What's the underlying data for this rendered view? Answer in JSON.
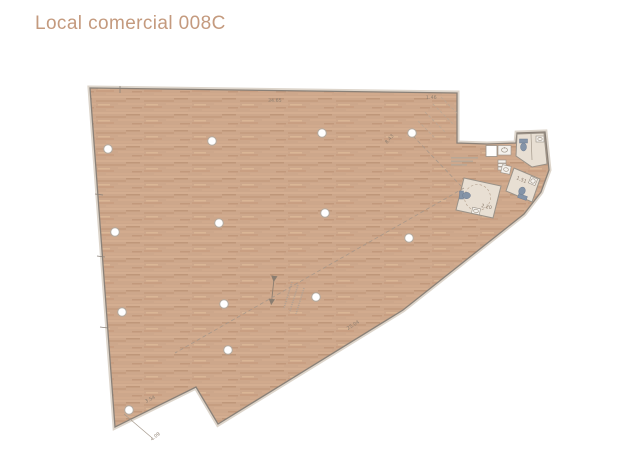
{
  "colors": {
    "title": "#c49a7e",
    "wood": "#cda78b",
    "wall": "#8a8178",
    "wall-light": "#ddd5cb",
    "dash": "#a8988a",
    "dim-text": "#8d7e6f",
    "bath-floor": "#e8dfd3",
    "fixture": "#8494a8"
  },
  "header": {
    "title": "Local comercial 008C"
  },
  "floor_plan": {
    "description": "floor-plan-of-commercial-unit-with-wood-floor-columns-and-restrooms",
    "columns": [
      [
        108,
        149
      ],
      [
        212,
        141
      ],
      [
        322,
        133
      ],
      [
        412,
        133
      ],
      [
        115,
        232
      ],
      [
        219,
        223
      ],
      [
        325,
        213
      ],
      [
        409,
        238
      ],
      [
        122,
        312
      ],
      [
        224,
        304
      ],
      [
        316,
        297
      ],
      [
        228,
        350
      ],
      [
        129,
        410
      ]
    ],
    "dimensions": [
      {
        "label": "34.65",
        "x": 268,
        "y": 102,
        "rotate": -1
      },
      {
        "label": "1.46",
        "x": 426,
        "y": 99,
        "rotate": -1
      },
      {
        "label": "25.04",
        "x": 348,
        "y": 330,
        "rotate": -32
      },
      {
        "label": "3.54",
        "x": 146,
        "y": 403,
        "rotate": -27
      },
      {
        "label": "4.09",
        "x": 152,
        "y": 441,
        "rotate": -38
      },
      {
        "label": "8.43",
        "x": 387,
        "y": 144,
        "rotate": -49
      },
      {
        "label": "2.20",
        "x": 481,
        "y": 207,
        "rotate": 12
      },
      {
        "label": "1.51",
        "x": 516,
        "y": 179,
        "rotate": 23
      }
    ],
    "dashed_lines": [
      {
        "x1": 464,
        "y1": 188,
        "x2": 175,
        "y2": 353
      },
      {
        "x1": 413,
        "y1": 136,
        "x2": 461,
        "y2": 186
      }
    ]
  }
}
